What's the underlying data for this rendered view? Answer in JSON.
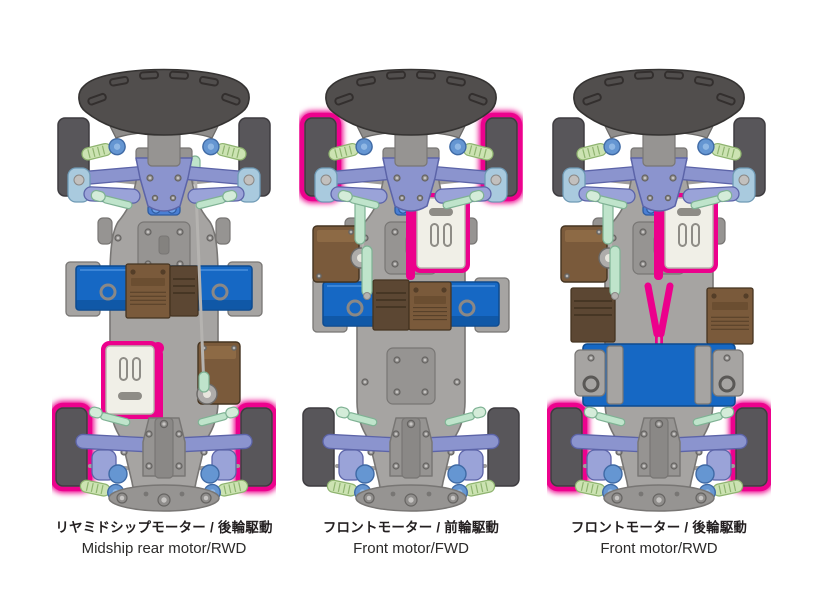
{
  "palette": {
    "background": "#ffffff",
    "highlight_pink": "#ec008c",
    "tire_gray": "#58565a",
    "tire_edge": "#3e3c40",
    "bumper_gray": "#514e4d",
    "bumper_edge": "#353332",
    "chassis_gray": "#a6a4a2",
    "chassis_mid": "#969492",
    "chassis_dark": "#787674",
    "suspension_periwinkle": "#8b94ce",
    "suspension_edge": "#5c64a8",
    "damper_blue": "#6596d2",
    "knuckle_blue": "#a9cade",
    "spring_green": "#cce3b2",
    "spring_edge": "#8fb470",
    "rod_green": "#bfe4cb",
    "rod_edge": "#7fb294",
    "battery_blue": "#1668c4",
    "battery_edge": "#0d4a8f",
    "esc_brown": "#7a5a3b",
    "esc_dark_brown": "#5c4733",
    "brown_edge": "#453421",
    "motor_cream": "#f0efe7",
    "motor_detail": "#8e8c86",
    "steering_blue": "#4a7fd4",
    "silver": "#b5b3b0",
    "label_color": "#231f20"
  },
  "variants": [
    {
      "id": "midship-rwd",
      "label_jp": "リヤミドシップモーター / 後輪駆動",
      "label_en": "Midship rear motor/RWD",
      "motor_position": "midship",
      "drive_type": "RWD",
      "highlighted_wheels": "rear",
      "battery_layout": "mid-transverse",
      "has_center_driveshaft": false
    },
    {
      "id": "front-fwd",
      "label_jp": "フロントモーター / 前輪駆動",
      "label_en": "Front motor/FWD",
      "motor_position": "front",
      "drive_type": "FWD",
      "highlighted_wheels": "front",
      "battery_layout": "rear-transverse",
      "has_center_driveshaft": false
    },
    {
      "id": "front-rwd",
      "label_jp": "フロントモーター / 後輪駆動",
      "label_en": "Front motor/RWD",
      "motor_position": "front",
      "drive_type": "RWD",
      "highlighted_wheels": "rear",
      "battery_layout": "mid-square",
      "has_center_driveshaft": true
    }
  ]
}
